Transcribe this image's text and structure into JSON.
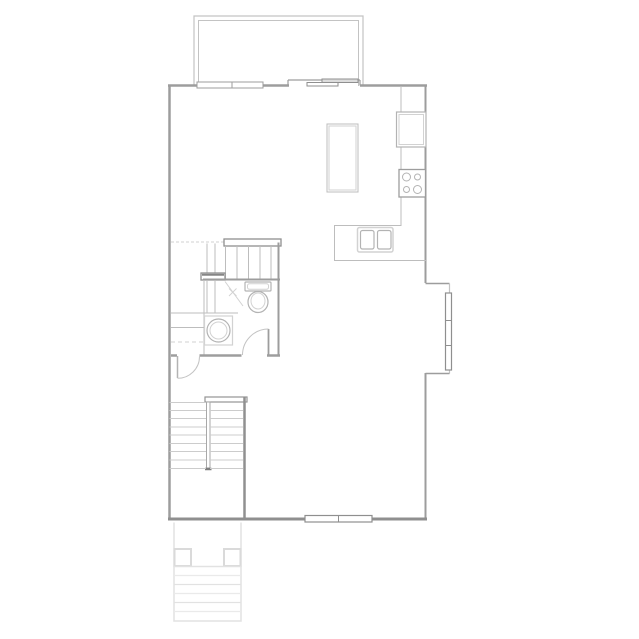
{
  "canvas": {
    "width": 639,
    "height": 639,
    "background": "#ffffff"
  },
  "colors": {
    "wall": "#9d9d9d",
    "wallDark": "#8f8f8f",
    "wallLight": "#c3c3c3",
    "thin": "#bdbdbd",
    "fixture": "#b3b3b3",
    "faint": "#d2d2d2",
    "stoop": "#e2e2e2",
    "stoopLight": "#eaeaea",
    "white": "#ffffff"
  },
  "shapes": [
    {
      "t": "polyline",
      "n": "deck-wall-outer",
      "points": "194,86 194,16 363,16 363,86",
      "s": "wallLight",
      "sw": 1.2
    },
    {
      "t": "polyline",
      "n": "deck-wall-inner",
      "points": "198.5,86 198.5,20.5 358.5,20.5 358.5,86",
      "s": "wallLight",
      "sw": 1
    },
    {
      "t": "line",
      "n": "exterior-wall-top-left",
      "x1": 168,
      "y1": 85.5,
      "x2": 197,
      "y2": 85.5,
      "s": "wall",
      "sw": 2.5
    },
    {
      "t": "line",
      "n": "exterior-wall-top-mid",
      "x1": 263,
      "y1": 85.5,
      "x2": 289,
      "y2": 85.5,
      "s": "wall",
      "sw": 2.5
    },
    {
      "t": "line",
      "n": "exterior-wall-top-right",
      "x1": 360,
      "y1": 85.5,
      "x2": 427,
      "y2": 85.5,
      "s": "wall",
      "sw": 2.5
    },
    {
      "t": "line",
      "n": "exterior-wall-left",
      "x1": 169.5,
      "y1": 84.5,
      "x2": 169.5,
      "y2": 520,
      "s": "wall",
      "sw": 2.5
    },
    {
      "t": "line",
      "n": "exterior-wall-right-upper",
      "x1": 425.5,
      "y1": 84.5,
      "x2": 425.5,
      "y2": 283,
      "s": "wall",
      "sw": 2
    },
    {
      "t": "line",
      "n": "bay-wall-top",
      "x1": 425.5,
      "y1": 283.5,
      "x2": 449.5,
      "y2": 283.5,
      "s": "wall",
      "sw": 1.5
    },
    {
      "t": "line",
      "n": "bay-wall-face",
      "x1": 449.5,
      "y1": 283.5,
      "x2": 449.5,
      "y2": 373.5,
      "s": "wallLight",
      "sw": 1.2
    },
    {
      "t": "line",
      "n": "bay-wall-bottom",
      "x1": 425.5,
      "y1": 373.5,
      "x2": 449.5,
      "y2": 373.5,
      "s": "wall",
      "sw": 1.5
    },
    {
      "t": "line",
      "n": "exterior-wall-right-lower",
      "x1": 425.5,
      "y1": 373,
      "x2": 425.5,
      "y2": 520,
      "s": "wall",
      "sw": 2
    },
    {
      "t": "line",
      "n": "exterior-wall-bottom",
      "x1": 168,
      "y1": 519,
      "x2": 427,
      "y2": 519,
      "s": "wallDark",
      "sw": 3
    },
    {
      "t": "rect",
      "n": "window-top",
      "x": 197,
      "y": 82,
      "wd": 66,
      "ht": 6,
      "s": "wall",
      "sw": 1,
      "f": "white"
    },
    {
      "t": "line",
      "n": "window-top-mullion",
      "x1": 232,
      "y1": 82,
      "x2": 232,
      "y2": 88,
      "s": "wall",
      "sw": 1
    },
    {
      "t": "line",
      "n": "slider-door-recess",
      "x1": 288,
      "y1": 80,
      "x2": 360,
      "y2": 80,
      "s": "wall",
      "sw": 1.2
    },
    {
      "t": "line",
      "n": "slider-door-jamb-left",
      "x1": 288,
      "y1": 80,
      "x2": 288,
      "y2": 85.5,
      "s": "wall",
      "sw": 1.2
    },
    {
      "t": "line",
      "n": "slider-door-jamb-right",
      "x1": 360,
      "y1": 80,
      "x2": 360,
      "y2": 85.5,
      "s": "wall",
      "sw": 1.2
    },
    {
      "t": "rect",
      "n": "slider-door-panel-inner",
      "x": 307,
      "y": 82.5,
      "wd": 31,
      "ht": 3.5,
      "s": "wallDark",
      "sw": 1,
      "f": "white"
    },
    {
      "t": "rect",
      "n": "slider-door-panel-outer",
      "x": 322,
      "y": 79,
      "wd": 36,
      "ht": 3.5,
      "s": "wallDark",
      "sw": 1,
      "f": "#dcdcdc"
    },
    {
      "t": "rect",
      "n": "window-bay",
      "x": 445.5,
      "y": 293,
      "wd": 6,
      "ht": 77,
      "s": "wallDark",
      "sw": 1.2,
      "f": "white"
    },
    {
      "t": "line",
      "n": "window-bay-mullion-1",
      "x1": 445.5,
      "y1": 320.5,
      "x2": 451.5,
      "y2": 320.5,
      "s": "wallDark",
      "sw": 1
    },
    {
      "t": "line",
      "n": "window-bay-mullion-2",
      "x1": 445.5,
      "y1": 345.5,
      "x2": 451.5,
      "y2": 345.5,
      "s": "wallDark",
      "sw": 1
    },
    {
      "t": "rect",
      "n": "window-bottom",
      "x": 305,
      "y": 515.5,
      "wd": 67,
      "ht": 6.5,
      "s": "wallDark",
      "sw": 1.2,
      "f": "white"
    },
    {
      "t": "line",
      "n": "window-bottom-mullion",
      "x1": 338.5,
      "y1": 515.5,
      "x2": 338.5,
      "y2": 522,
      "s": "wallDark",
      "sw": 1
    },
    {
      "t": "polyline",
      "n": "kitchen-counter-edge",
      "points": "401,86 401,225.5 334.5,225.5 334.5,260.5 426,260.5",
      "s": "thin",
      "sw": 1
    },
    {
      "t": "rect",
      "n": "refrigerator",
      "x": 396.5,
      "y": 112,
      "wd": 29.5,
      "ht": 35,
      "s": "fixture",
      "sw": 1.2,
      "f": "white"
    },
    {
      "t": "rect",
      "n": "refrigerator-inner",
      "x": 399,
      "y": 114.5,
      "wd": 24.5,
      "ht": 30,
      "s": "faint",
      "sw": 1
    },
    {
      "t": "rect",
      "n": "stove",
      "x": 399,
      "y": 169.5,
      "wd": 26.5,
      "ht": 27.5,
      "s": "wall",
      "sw": 1.3,
      "f": "white"
    },
    {
      "t": "circle",
      "n": "stove-burner-1",
      "cx": 406.5,
      "cy": 177,
      "r": 4,
      "s": "fixture",
      "sw": 1
    },
    {
      "t": "circle",
      "n": "stove-burner-2",
      "cx": 417.5,
      "cy": 177,
      "r": 3,
      "s": "fixture",
      "sw": 1
    },
    {
      "t": "circle",
      "n": "stove-burner-3",
      "cx": 406.5,
      "cy": 189.5,
      "r": 3,
      "s": "fixture",
      "sw": 1
    },
    {
      "t": "circle",
      "n": "stove-burner-4",
      "cx": 417.5,
      "cy": 189.5,
      "r": 4,
      "s": "fixture",
      "sw": 1
    },
    {
      "t": "rect",
      "n": "kitchen-sink",
      "x": 357.5,
      "y": 227.5,
      "wd": 35.5,
      "ht": 24.5,
      "rx": 2,
      "s": "faint",
      "sw": 1.5,
      "f": "white"
    },
    {
      "t": "rect",
      "n": "kitchen-sink-basin-left",
      "x": 360.5,
      "y": 230.5,
      "wd": 13.5,
      "ht": 18.5,
      "rx": 2,
      "s": "fixture",
      "sw": 1.2
    },
    {
      "t": "rect",
      "n": "kitchen-sink-basin-right",
      "x": 377.5,
      "y": 230.5,
      "wd": 13.5,
      "ht": 18.5,
      "rx": 2,
      "s": "fixture",
      "sw": 1.2
    },
    {
      "t": "rect",
      "n": "kitchen-island",
      "x": 327,
      "y": 124,
      "wd": 31,
      "ht": 68,
      "s": "thin",
      "sw": 1,
      "f": "white"
    },
    {
      "t": "rect",
      "n": "kitchen-island-inner",
      "x": 329,
      "y": 126,
      "wd": 27,
      "ht": 64,
      "s": "faint",
      "sw": 1
    },
    {
      "t": "line",
      "n": "floor-above-edge-dashed",
      "x1": 171,
      "y1": 242,
      "x2": 224,
      "y2": 242,
      "s": "faint",
      "sw": 1,
      "da": "3,2"
    },
    {
      "t": "line",
      "n": "stair-winder-upper-1",
      "x1": 207,
      "y1": 243.5,
      "x2": 207,
      "y2": 273,
      "s": "thin",
      "sw": 1
    },
    {
      "t": "line",
      "n": "stair-winder-upper-2",
      "x1": 215,
      "y1": 243.5,
      "x2": 215,
      "y2": 273,
      "s": "thin",
      "sw": 1
    },
    {
      "t": "rect",
      "n": "stair-header-rail",
      "x": 224,
      "y": 239,
      "wd": 57,
      "ht": 7,
      "s": "wallDark",
      "sw": 1.3,
      "f": "white"
    },
    {
      "t": "line",
      "n": "stair-tread-edge",
      "x1": 225.5,
      "y1": 246,
      "x2": 225.5,
      "y2": 279,
      "s": "thin",
      "sw": 1
    },
    {
      "t": "line",
      "n": "stair-tread-1",
      "x1": 237,
      "y1": 246,
      "x2": 237,
      "y2": 279,
      "s": "thin",
      "sw": 1
    },
    {
      "t": "line",
      "n": "stair-tread-2",
      "x1": 248.5,
      "y1": 246,
      "x2": 248.5,
      "y2": 279,
      "s": "thin",
      "sw": 1
    },
    {
      "t": "line",
      "n": "stair-tread-3",
      "x1": 260,
      "y1": 246,
      "x2": 260,
      "y2": 279,
      "s": "thin",
      "sw": 1
    },
    {
      "t": "line",
      "n": "stair-tread-4",
      "x1": 271,
      "y1": 246,
      "x2": 271,
      "y2": 279,
      "s": "thin",
      "sw": 1
    },
    {
      "t": "rect",
      "n": "stair-mid-rail",
      "x": 201,
      "y": 273,
      "wd": 24,
      "ht": 7,
      "s": "wallDark",
      "sw": 1.3,
      "f": "white"
    },
    {
      "t": "line",
      "n": "stair-mid-rail-cap",
      "x1": 202,
      "y1": 274.8,
      "x2": 224,
      "y2": 274.8,
      "s": "#858585",
      "sw": 2
    },
    {
      "t": "line",
      "n": "bathroom-wall-top",
      "x1": 203,
      "y1": 279.5,
      "x2": 280,
      "y2": 279.5,
      "s": "wall",
      "sw": 2
    },
    {
      "t": "line",
      "n": "stair-winder-lower-1",
      "x1": 207,
      "y1": 281,
      "x2": 207,
      "y2": 313,
      "s": "thin",
      "sw": 1
    },
    {
      "t": "line",
      "n": "stair-winder-lower-2",
      "x1": 215,
      "y1": 281,
      "x2": 215,
      "y2": 313,
      "s": "thin",
      "sw": 1
    },
    {
      "t": "line",
      "n": "closet-partition-wall",
      "x1": 204,
      "y1": 281,
      "x2": 204,
      "y2": 355,
      "s": "thin",
      "sw": 1
    },
    {
      "t": "line",
      "n": "stair-direction-arrow",
      "x1": 225,
      "y1": 281.5,
      "x2": 243,
      "y2": 306,
      "s": "faint",
      "sw": 1
    },
    {
      "t": "line",
      "n": "stair-arrow-x-1",
      "x1": 229,
      "y1": 288.5,
      "x2": 236.5,
      "y2": 296,
      "s": "faint",
      "sw": 1
    },
    {
      "t": "line",
      "n": "stair-arrow-x-2",
      "x1": 236.5,
      "y1": 288.5,
      "x2": 229,
      "y2": 296,
      "s": "faint",
      "sw": 1
    },
    {
      "t": "line",
      "n": "hall-line-1",
      "x1": 171,
      "y1": 313,
      "x2": 238,
      "y2": 313,
      "s": "thin",
      "sw": 1
    },
    {
      "t": "line",
      "n": "hall-line-2",
      "x1": 171,
      "y1": 327.5,
      "x2": 204,
      "y2": 327.5,
      "s": "thin",
      "sw": 1
    },
    {
      "t": "line",
      "n": "hall-shelf-dashed",
      "x1": 171,
      "y1": 342,
      "x2": 204,
      "y2": 342,
      "s": "faint",
      "sw": 1,
      "da": "4,3"
    },
    {
      "t": "line",
      "n": "bathroom-wall-right",
      "x1": 278.5,
      "y1": 242.5,
      "x2": 278.5,
      "y2": 356,
      "s": "wall",
      "sw": 2
    },
    {
      "t": "rect",
      "n": "toilet-tank",
      "x": 245,
      "y": 282,
      "wd": 26,
      "ht": 9,
      "rx": 1,
      "s": "fixture",
      "sw": 1.2,
      "f": "white"
    },
    {
      "t": "rect",
      "n": "toilet-tank-inner",
      "x": 247.5,
      "y": 283.8,
      "wd": 21,
      "ht": 5.5,
      "rx": 2,
      "s": "faint",
      "sw": 1
    },
    {
      "t": "ellipse",
      "n": "toilet-bowl",
      "cx": 258,
      "cy": 302,
      "rx": 10,
      "ry": 10.5,
      "s": "fixture",
      "sw": 1.2,
      "f": "white"
    },
    {
      "t": "ellipse",
      "n": "toilet-bowl-inner",
      "cx": 258,
      "cy": 301,
      "rx": 7,
      "ry": 8,
      "s": "faint",
      "sw": 1
    },
    {
      "t": "rect",
      "n": "vanity-counter",
      "x": 204.5,
      "y": 316,
      "wd": 28,
      "ht": 29,
      "s": "faint",
      "sw": 1.2
    },
    {
      "t": "circle",
      "n": "vanity-sink-outer",
      "cx": 218.5,
      "cy": 330.5,
      "r": 11.5,
      "s": "fixture",
      "sw": 1.2,
      "f": "white"
    },
    {
      "t": "circle",
      "n": "vanity-sink-inner",
      "cx": 218.5,
      "cy": 330.5,
      "r": 8.5,
      "s": "faint",
      "sw": 1
    },
    {
      "t": "line",
      "n": "bathroom-wall-bottom-a",
      "x1": 171,
      "y1": 355.5,
      "x2": 177,
      "y2": 355.5,
      "s": "wall",
      "sw": 2.5
    },
    {
      "t": "line",
      "n": "bathroom-wall-bottom-b",
      "x1": 199.5,
      "y1": 355.5,
      "x2": 241.5,
      "y2": 355.5,
      "s": "wall",
      "sw": 2.5
    },
    {
      "t": "line",
      "n": "bathroom-wall-bottom-c",
      "x1": 267,
      "y1": 355.5,
      "x2": 280,
      "y2": 355.5,
      "s": "wall",
      "sw": 2.5
    },
    {
      "t": "line",
      "n": "bathroom-door-leaf",
      "x1": 268.5,
      "y1": 329,
      "x2": 268.5,
      "y2": 355.5,
      "s": "wall",
      "sw": 1.8
    },
    {
      "t": "path",
      "n": "bathroom-door-arc",
      "d": "M242.5,355 A26,26 0 0 1 268.5,329",
      "s": "wallLight",
      "sw": 1
    },
    {
      "t": "line",
      "n": "closet-door-leaf",
      "x1": 177.5,
      "y1": 356,
      "x2": 177.5,
      "y2": 378,
      "s": "fixture",
      "sw": 1.5
    },
    {
      "t": "path",
      "n": "closet-door-arc",
      "d": "M199.5,356.5 A21.8,21.8 0 0 1 177.5,378.3",
      "s": "wallLight",
      "sw": 1
    },
    {
      "t": "rect",
      "n": "lower-stair-head-wall",
      "x": 205,
      "y": 397,
      "wd": 42,
      "ht": 5,
      "s": "#949494",
      "sw": 1.2,
      "f": "white"
    },
    {
      "t": "line",
      "n": "stair-shaft-wall-right",
      "x1": 244.5,
      "y1": 397,
      "x2": 244.5,
      "y2": 519,
      "s": "#909090",
      "sw": 2.5
    },
    {
      "t": "rect",
      "n": "stair-divider-wall",
      "x": 206.5,
      "y": 402,
      "wd": 3.5,
      "ht": 66,
      "s": "#a8a8a8",
      "sw": 1,
      "f": "white"
    },
    {
      "t": "line",
      "n": "stair-divider-cap",
      "x1": 205,
      "y1": 469,
      "x2": 211.5,
      "y2": 469,
      "s": "#7f7f7f",
      "sw": 2.5
    },
    {
      "t": "line",
      "n": "lower-stair-left-tread-1",
      "x1": 169.5,
      "y1": 402.5,
      "x2": 206,
      "y2": 402.5,
      "s": "#cccccc",
      "sw": 1
    },
    {
      "t": "line",
      "n": "lower-stair-left-tread-2",
      "x1": 169.5,
      "y1": 410.5,
      "x2": 206,
      "y2": 410.5,
      "s": "#cccccc",
      "sw": 1
    },
    {
      "t": "line",
      "n": "lower-stair-left-tread-3",
      "x1": 169.5,
      "y1": 418.5,
      "x2": 206,
      "y2": 418.5,
      "s": "#cccccc",
      "sw": 1
    },
    {
      "t": "line",
      "n": "lower-stair-left-tread-4",
      "x1": 169.5,
      "y1": 427,
      "x2": 206,
      "y2": 427,
      "s": "#cccccc",
      "sw": 1
    },
    {
      "t": "line",
      "n": "lower-stair-left-tread-5",
      "x1": 169.5,
      "y1": 435,
      "x2": 206,
      "y2": 435,
      "s": "#cccccc",
      "sw": 1
    },
    {
      "t": "line",
      "n": "lower-stair-left-tread-6",
      "x1": 169.5,
      "y1": 443.5,
      "x2": 206,
      "y2": 443.5,
      "s": "#cccccc",
      "sw": 1
    },
    {
      "t": "line",
      "n": "lower-stair-left-tread-7",
      "x1": 169.5,
      "y1": 451.5,
      "x2": 206,
      "y2": 451.5,
      "s": "#cccccc",
      "sw": 1
    },
    {
      "t": "line",
      "n": "lower-stair-left-tread-8",
      "x1": 169.5,
      "y1": 460,
      "x2": 206,
      "y2": 460,
      "s": "#cccccc",
      "sw": 1
    },
    {
      "t": "line",
      "n": "lower-stair-left-tread-9",
      "x1": 169.5,
      "y1": 468.5,
      "x2": 206,
      "y2": 468.5,
      "s": "#cccccc",
      "sw": 1
    },
    {
      "t": "line",
      "n": "lower-stair-right-tread-1",
      "x1": 210,
      "y1": 410.5,
      "x2": 243,
      "y2": 410.5,
      "s": "#cccccc",
      "sw": 1
    },
    {
      "t": "line",
      "n": "lower-stair-right-tread-2",
      "x1": 210,
      "y1": 418.5,
      "x2": 243,
      "y2": 418.5,
      "s": "#cccccc",
      "sw": 1
    },
    {
      "t": "line",
      "n": "lower-stair-right-tread-3",
      "x1": 210,
      "y1": 427,
      "x2": 243,
      "y2": 427,
      "s": "#cccccc",
      "sw": 1
    },
    {
      "t": "line",
      "n": "lower-stair-right-tread-4",
      "x1": 210,
      "y1": 435,
      "x2": 243,
      "y2": 435,
      "s": "#cccccc",
      "sw": 1
    },
    {
      "t": "line",
      "n": "lower-stair-right-tread-5",
      "x1": 210,
      "y1": 443.5,
      "x2": 243,
      "y2": 443.5,
      "s": "#cccccc",
      "sw": 1
    },
    {
      "t": "line",
      "n": "lower-stair-right-tread-6",
      "x1": 210,
      "y1": 451.5,
      "x2": 243,
      "y2": 451.5,
      "s": "#cccccc",
      "sw": 1
    },
    {
      "t": "line",
      "n": "lower-stair-right-tread-7",
      "x1": 210,
      "y1": 460,
      "x2": 243,
      "y2": 460,
      "s": "#cccccc",
      "sw": 1
    },
    {
      "t": "line",
      "n": "lower-stair-right-tread-8",
      "x1": 210,
      "y1": 468.5,
      "x2": 243,
      "y2": 468.5,
      "s": "#cccccc",
      "sw": 1
    },
    {
      "t": "polyline",
      "n": "entry-stoop-outline",
      "points": "174,522.5 174,621 241,621 241,522.5",
      "s": "stoop",
      "sw": 1.5
    },
    {
      "t": "rect",
      "n": "stoop-post-left",
      "x": 174.5,
      "y": 549,
      "wd": 16.5,
      "ht": 17,
      "s": "#dadada",
      "sw": 2,
      "f": "white"
    },
    {
      "t": "rect",
      "n": "stoop-post-right",
      "x": 224,
      "y": 549,
      "wd": 16.5,
      "ht": 17,
      "s": "#dadada",
      "sw": 2,
      "f": "white"
    },
    {
      "t": "line",
      "n": "stoop-landing-edge",
      "x1": 174,
      "y1": 566.5,
      "x2": 241,
      "y2": 566.5,
      "s": "stoop",
      "sw": 1.5
    },
    {
      "t": "line",
      "n": "stoop-step-1",
      "x1": 174,
      "y1": 575.5,
      "x2": 241,
      "y2": 575.5,
      "s": "stoopLight",
      "sw": 1.2
    },
    {
      "t": "line",
      "n": "stoop-step-2",
      "x1": 174,
      "y1": 584.5,
      "x2": 241,
      "y2": 584.5,
      "s": "stoop",
      "sw": 1.2
    },
    {
      "t": "line",
      "n": "stoop-step-3",
      "x1": 174,
      "y1": 593.5,
      "x2": 241,
      "y2": 593.5,
      "s": "stoopLight",
      "sw": 1.2
    },
    {
      "t": "line",
      "n": "stoop-step-4",
      "x1": 174,
      "y1": 602.5,
      "x2": 241,
      "y2": 602.5,
      "s": "stoop",
      "sw": 1.2
    },
    {
      "t": "line",
      "n": "stoop-step-5",
      "x1": 174,
      "y1": 611.5,
      "x2": 241,
      "y2": 611.5,
      "s": "stoopLight",
      "sw": 1.2
    }
  ]
}
